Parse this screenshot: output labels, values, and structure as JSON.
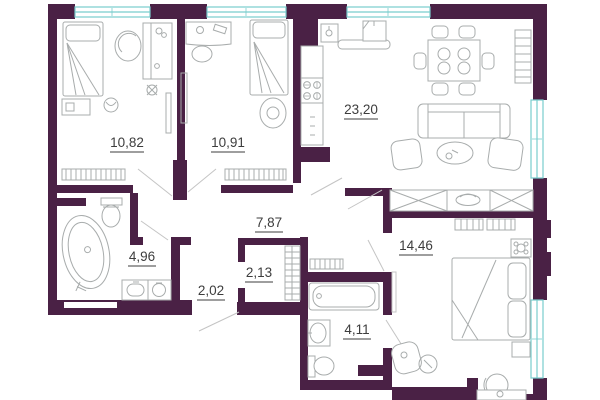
{
  "plan": {
    "type": "apartment-floor-plan",
    "rooms": [
      {
        "id": "bedroom-1",
        "area_label": "10,82"
      },
      {
        "id": "bedroom-2",
        "area_label": "10,91"
      },
      {
        "id": "kitchen-living",
        "area_label": "23,20"
      },
      {
        "id": "hallway",
        "area_label": "7,87"
      },
      {
        "id": "bathroom-1",
        "area_label": "4,96"
      },
      {
        "id": "entry-corridor",
        "area_label": "2,02"
      },
      {
        "id": "wardrobe-closet",
        "area_label": "2,13"
      },
      {
        "id": "master-bedroom",
        "area_label": "14,46"
      },
      {
        "id": "bathroom-2",
        "area_label": "4,11"
      }
    ],
    "colors": {
      "wall": "#4a2145",
      "window": "#79cdcd",
      "furniture_outline": "#a8acac",
      "door_line": "#c4c4c4",
      "label_text": "#3d3d3d",
      "background": "#ffffff"
    }
  }
}
